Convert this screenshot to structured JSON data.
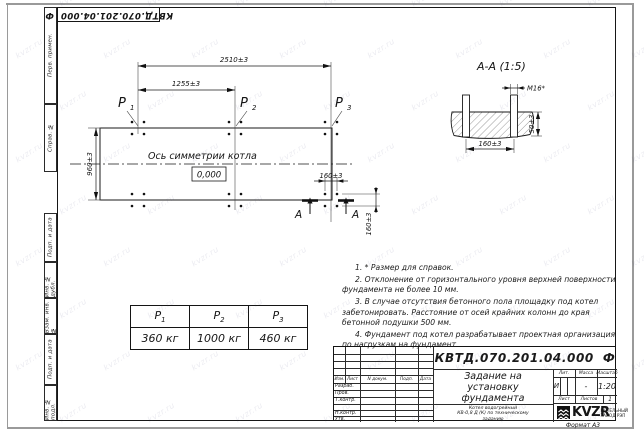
{
  "doc": {
    "number": "КВТД.070.201.04.000",
    "suffix": "Ф"
  },
  "watermark": {
    "text": "kvzr.ru"
  },
  "margin_cells": [
    "Перв. примен.",
    "Справ. №",
    "Подп. и дата",
    "Инв. № дубл.",
    "Взам. инв. №",
    "Подп. и дата",
    "Инв. № подл."
  ],
  "plan": {
    "dim_total": "2510±3",
    "dim_half": "1255±3",
    "dim_side": "960±3",
    "dim_bolt_h": "160±3",
    "dim_bolt_v": "160±3",
    "axis_label": "Ось симметрии котла",
    "level_mark": "0,000",
    "cut_label": "А",
    "loads": [
      {
        "p": "P",
        "sub": "1"
      },
      {
        "p": "P",
        "sub": "2"
      },
      {
        "p": "P",
        "sub": "3"
      }
    ]
  },
  "section": {
    "title": "А-А (1:5)",
    "thread": "М16*",
    "dim_spacing": "160±3",
    "dim_emb": "50±3"
  },
  "load_table": {
    "headers": [
      {
        "p": "P",
        "sub": "1"
      },
      {
        "p": "P",
        "sub": "2"
      },
      {
        "p": "P",
        "sub": "3"
      }
    ],
    "values": [
      "360 кг",
      "1000 кг",
      "460 кг"
    ]
  },
  "notes": {
    "lines": [
      "1. * Размер для справок.",
      "2. Отклонение от горизонтального уровня верхней поверхности фундамента не более 10 мм.",
      "3. В случае отсутствия бетонного пола площадку под котел забетонировать. Расстояние от осей крайних колонн до края бетонной подушки 500 мм.",
      "4. Фундамент под котел разрабатывает проектная организация по нагрузкам на фундамент."
    ]
  },
  "title_block": {
    "title_lines": [
      "Задание на",
      "установку",
      "фундамента"
    ],
    "product_lines": [
      "Котел водогрейный",
      "КВ-0,8 Д (К) по техническому",
      "заданию"
    ],
    "cols": [
      "Изм.",
      "Лист",
      "N докум.",
      "Подп.",
      "Дата"
    ],
    "rows": [
      "Разраб.",
      "Пров.",
      "Т.контр.",
      "Н.контр.",
      "Утв."
    ],
    "lit_label": "Лит.",
    "lit_value": "И",
    "mass_label": "Масса",
    "mass_value": "-",
    "scale_label": "Масштаб",
    "scale_value": "1:20",
    "sheet_label": "Лист",
    "sheets_label": "Листов",
    "sheets_value": "1",
    "logo_text": "KVZR",
    "company_lines": [
      "КОТЕЛЬНЫЙ",
      "ЗАВОД РЭП"
    ]
  },
  "footer": {
    "format_label": "Формат А3"
  }
}
